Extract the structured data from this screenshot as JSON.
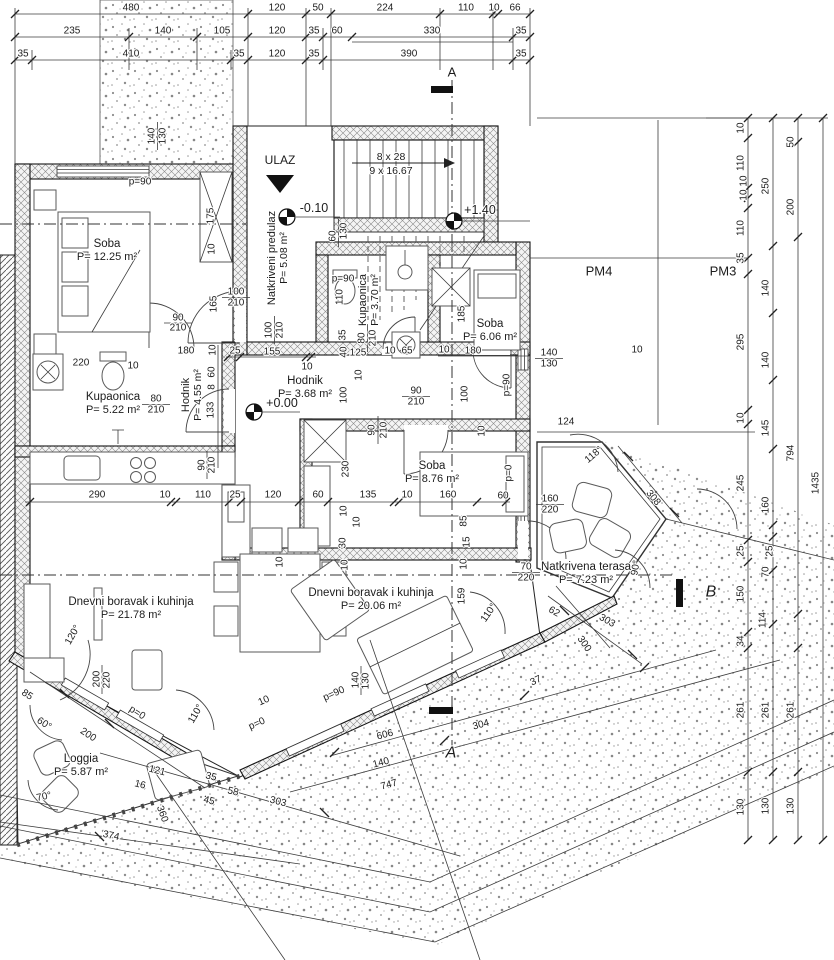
{
  "drawing": {
    "kind": "floor-plan",
    "entry_label": "ULAZ",
    "stairs": {
      "line1": "8 x 28",
      "line2": "9 x 16.67"
    },
    "levels": [
      {
        "t": "-0.10",
        "x": 314,
        "y": 208
      },
      {
        "t": "+1.40",
        "x": 480,
        "y": 210
      },
      {
        "t": "+0.00",
        "x": 282,
        "y": 403
      }
    ],
    "parking": [
      {
        "t": "PM4",
        "x": 599,
        "y": 271
      },
      {
        "t": "PM3",
        "x": 723,
        "y": 271
      }
    ],
    "sections": [
      {
        "t": "A",
        "x": 452,
        "y": 72
      },
      {
        "t": "A",
        "x": 451,
        "y": 753
      },
      {
        "t": "B",
        "x": 711,
        "y": 592
      }
    ],
    "rooms": [
      {
        "name": "Soba",
        "area": "P= 12.25 m²",
        "x": 107,
        "y": 244,
        "o": "h"
      },
      {
        "name": "Natkriveni predulaz",
        "area": "P= 5.08 m²",
        "x": 272,
        "y": 258,
        "o": "v"
      },
      {
        "name": "Kupaonica",
        "area": "P= 3.70 m²",
        "x": 363,
        "y": 300,
        "o": "v"
      },
      {
        "name": "Soba",
        "area": "P= 6.06 m²",
        "x": 490,
        "y": 324,
        "o": "h"
      },
      {
        "name": "Kupaonica",
        "area": "P= 5.22 m²",
        "x": 113,
        "y": 397,
        "o": "h"
      },
      {
        "name": "Hodnik",
        "area": "P= 4.55 m²",
        "x": 186,
        "y": 395,
        "o": "v"
      },
      {
        "name": "Hodnik",
        "area": "P= 3.68 m²",
        "x": 305,
        "y": 381,
        "o": "h"
      },
      {
        "name": "Soba",
        "area": "P= 8.76 m²",
        "x": 432,
        "y": 466,
        "o": "h"
      },
      {
        "name": "Dnevni boravak i kuhinja",
        "area": "P= 21.78 m²",
        "x": 131,
        "y": 602,
        "o": "h"
      },
      {
        "name": "Dnevni boravak i kuhinja",
        "area": "P= 20.06 m²",
        "x": 371,
        "y": 593,
        "o": "h"
      },
      {
        "name": "Loggia",
        "area": "P= 5.87 m²",
        "x": 81,
        "y": 759,
        "o": "h"
      },
      {
        "name": "Natkrivena terasa",
        "area": "P= 7.23 m²",
        "x": 586,
        "y": 567,
        "o": "h"
      }
    ],
    "dims": [
      {
        "t": "480",
        "x": 131,
        "y": 8
      },
      {
        "t": "120",
        "x": 277,
        "y": 8
      },
      {
        "t": "50",
        "x": 318,
        "y": 8
      },
      {
        "t": "224",
        "x": 385,
        "y": 8
      },
      {
        "t": "110",
        "x": 466,
        "y": 8
      },
      {
        "t": "10",
        "x": 494,
        "y": 8
      },
      {
        "t": "66",
        "x": 515,
        "y": 8
      },
      {
        "t": "235",
        "x": 72,
        "y": 31
      },
      {
        "t": "140",
        "x": 163,
        "y": 31
      },
      {
        "t": "105",
        "x": 222,
        "y": 31
      },
      {
        "t": "120",
        "x": 277,
        "y": 31
      },
      {
        "t": "35",
        "x": 314,
        "y": 31
      },
      {
        "t": "60",
        "x": 337,
        "y": 31
      },
      {
        "t": "330",
        "x": 432,
        "y": 31
      },
      {
        "t": "35",
        "x": 521,
        "y": 31
      },
      {
        "t": "35",
        "x": 23,
        "y": 54
      },
      {
        "t": "410",
        "x": 131,
        "y": 54
      },
      {
        "t": "35",
        "x": 239,
        "y": 54
      },
      {
        "t": "120",
        "x": 277,
        "y": 54
      },
      {
        "t": "35",
        "x": 314,
        "y": 54
      },
      {
        "t": "390",
        "x": 409,
        "y": 54
      },
      {
        "t": "35",
        "x": 521,
        "y": 54
      },
      {
        "t": "p=90",
        "x": 140,
        "y": 182
      },
      {
        "t": "140",
        "x": 152,
        "y": 136,
        "r": -90
      },
      {
        "t": "130",
        "x": 163,
        "y": 136,
        "r": -90
      },
      {
        "t": "175",
        "x": 211,
        "y": 216,
        "r": -90
      },
      {
        "t": "10",
        "x": 212,
        "y": 249,
        "r": -90
      },
      {
        "t": "60",
        "x": 333,
        "y": 236,
        "r": -90
      },
      {
        "t": "130",
        "x": 344,
        "y": 231,
        "r": -90
      },
      {
        "t": "100",
        "x": 269,
        "y": 330,
        "r": -90
      },
      {
        "t": "210",
        "x": 280,
        "y": 330,
        "r": -90
      },
      {
        "t": "100",
        "x": 236,
        "y": 292
      },
      {
        "t": "210",
        "x": 236,
        "y": 303
      },
      {
        "t": "90",
        "x": 178,
        "y": 318
      },
      {
        "t": "210",
        "x": 178,
        "y": 328
      },
      {
        "t": "165",
        "x": 214,
        "y": 304,
        "r": -90
      },
      {
        "t": "180",
        "x": 186,
        "y": 351
      },
      {
        "t": "25",
        "x": 235,
        "y": 351
      },
      {
        "t": "155",
        "x": 272,
        "y": 352
      },
      {
        "t": "10",
        "x": 307,
        "y": 367
      },
      {
        "t": "220",
        "x": 81,
        "y": 363
      },
      {
        "t": "10",
        "x": 133,
        "y": 366
      },
      {
        "t": "10",
        "x": 213,
        "y": 350,
        "r": -90
      },
      {
        "t": "60",
        "x": 212,
        "y": 372,
        "r": -90
      },
      {
        "t": "8",
        "x": 212,
        "y": 387,
        "r": -90
      },
      {
        "t": "133",
        "x": 211,
        "y": 410,
        "r": -90
      },
      {
        "t": "80",
        "x": 156,
        "y": 399
      },
      {
        "t": "210",
        "x": 156,
        "y": 410
      },
      {
        "t": "90",
        "x": 202,
        "y": 465,
        "r": -90
      },
      {
        "t": "210",
        "x": 212,
        "y": 465,
        "r": -90
      },
      {
        "t": "p=90",
        "x": 343,
        "y": 279
      },
      {
        "t": "110",
        "x": 340,
        "y": 297,
        "r": -90
      },
      {
        "t": "35",
        "x": 343,
        "y": 335,
        "r": -90
      },
      {
        "t": "40",
        "x": 344,
        "y": 352,
        "r": -90
      },
      {
        "t": "125",
        "x": 358,
        "y": 353
      },
      {
        "t": "10",
        "x": 390,
        "y": 351
      },
      {
        "t": "65",
        "x": 407,
        "y": 351
      },
      {
        "t": "10",
        "x": 444,
        "y": 350
      },
      {
        "t": "180",
        "x": 473,
        "y": 351
      },
      {
        "t": "10",
        "x": 637,
        "y": 350
      },
      {
        "t": "80",
        "x": 362,
        "y": 338,
        "r": -90
      },
      {
        "t": "210",
        "x": 373,
        "y": 338,
        "r": -90
      },
      {
        "t": "10",
        "x": 359,
        "y": 375,
        "r": -90
      },
      {
        "t": "100",
        "x": 344,
        "y": 395,
        "r": -90
      },
      {
        "t": "90",
        "x": 416,
        "y": 391
      },
      {
        "t": "210",
        "x": 416,
        "y": 402
      },
      {
        "t": "100",
        "x": 465,
        "y": 394,
        "r": -90
      },
      {
        "t": "90",
        "x": 372,
        "y": 430,
        "r": -90
      },
      {
        "t": "210",
        "x": 384,
        "y": 430,
        "r": -90
      },
      {
        "t": "230",
        "x": 346,
        "y": 469,
        "r": -90
      },
      {
        "t": "185",
        "x": 462,
        "y": 314,
        "r": -90
      },
      {
        "t": "140",
        "x": 549,
        "y": 353
      },
      {
        "t": "130",
        "x": 549,
        "y": 364
      },
      {
        "t": "p=90",
        "x": 507,
        "y": 385,
        "r": -90
      },
      {
        "t": "10",
        "x": 482,
        "y": 431,
        "r": -90
      },
      {
        "t": "124",
        "x": 566,
        "y": 422
      },
      {
        "t": "290",
        "x": 97,
        "y": 495
      },
      {
        "t": "10",
        "x": 165,
        "y": 495
      },
      {
        "t": "110",
        "x": 203,
        "y": 495
      },
      {
        "t": "25",
        "x": 235,
        "y": 495
      },
      {
        "t": "120",
        "x": 273,
        "y": 495
      },
      {
        "t": "60",
        "x": 318,
        "y": 495
      },
      {
        "t": "135",
        "x": 368,
        "y": 495
      },
      {
        "t": "10",
        "x": 407,
        "y": 495
      },
      {
        "t": "160",
        "x": 448,
        "y": 495
      },
      {
        "t": "60",
        "x": 503,
        "y": 496
      },
      {
        "t": "160",
        "x": 550,
        "y": 499
      },
      {
        "t": "220",
        "x": 550,
        "y": 510
      },
      {
        "t": "10",
        "x": 344,
        "y": 511,
        "r": -90
      },
      {
        "t": "10",
        "x": 357,
        "y": 522,
        "r": -90
      },
      {
        "t": "30",
        "x": 343,
        "y": 543,
        "r": -90
      },
      {
        "t": "10",
        "x": 345,
        "y": 565,
        "r": -90
      },
      {
        "t": "85",
        "x": 464,
        "y": 521,
        "r": -90
      },
      {
        "t": "15",
        "x": 467,
        "y": 542,
        "r": -90
      },
      {
        "t": "10",
        "x": 464,
        "y": 564,
        "r": -90
      },
      {
        "t": "70",
        "x": 526,
        "y": 567
      },
      {
        "t": "220",
        "x": 526,
        "y": 578
      },
      {
        "t": "10",
        "x": 280,
        "y": 562,
        "r": -90
      },
      {
        "t": "159",
        "x": 462,
        "y": 596,
        "r": -90
      },
      {
        "t": "140",
        "x": 356,
        "y": 680,
        "r": -90
      },
      {
        "t": "130",
        "x": 366,
        "y": 681,
        "r": -90
      },
      {
        "t": "200",
        "x": 97,
        "y": 679,
        "r": -90
      },
      {
        "t": "220",
        "x": 107,
        "y": 680,
        "r": -90
      },
      {
        "t": "120°",
        "x": 73,
        "y": 635,
        "r": -60
      },
      {
        "t": "110°",
        "x": 196,
        "y": 714,
        "r": -60
      },
      {
        "t": "110°",
        "x": 489,
        "y": 613,
        "r": -55
      },
      {
        "t": "60°",
        "x": 44,
        "y": 724,
        "r": 33
      },
      {
        "t": "70°",
        "x": 44,
        "y": 797,
        "r": -12
      },
      {
        "t": "85",
        "x": 27,
        "y": 695,
        "r": 33
      },
      {
        "t": "200",
        "x": 88,
        "y": 735,
        "r": 33
      },
      {
        "t": "p=0",
        "x": 137,
        "y": 713,
        "r": 33
      },
      {
        "t": "p=0",
        "x": 509,
        "y": 473,
        "r": -90
      },
      {
        "t": "p=0",
        "x": 257,
        "y": 724,
        "r": -24
      },
      {
        "t": "10",
        "x": 264,
        "y": 701,
        "r": -24
      },
      {
        "t": "p=90",
        "x": 334,
        "y": 694,
        "r": -24
      },
      {
        "t": "121",
        "x": 157,
        "y": 771,
        "r": 14
      },
      {
        "t": "16",
        "x": 140,
        "y": 785,
        "r": 14
      },
      {
        "t": "35",
        "x": 211,
        "y": 777,
        "r": 14
      },
      {
        "t": "45",
        "x": 209,
        "y": 801,
        "r": 14
      },
      {
        "t": "58",
        "x": 233,
        "y": 792,
        "r": 14
      },
      {
        "t": "303",
        "x": 278,
        "y": 802,
        "r": 14
      },
      {
        "t": "374",
        "x": 111,
        "y": 836,
        "r": 12
      },
      {
        "t": "360",
        "x": 162,
        "y": 814,
        "r": 70
      },
      {
        "t": "606",
        "x": 385,
        "y": 735,
        "r": -15
      },
      {
        "t": "304",
        "x": 481,
        "y": 725,
        "r": -15
      },
      {
        "t": "140",
        "x": 381,
        "y": 763,
        "r": -15
      },
      {
        "t": "747",
        "x": 389,
        "y": 785,
        "r": -15
      },
      {
        "t": "37",
        "x": 536,
        "y": 681,
        "r": -25
      },
      {
        "t": "118°",
        "x": 594,
        "y": 455,
        "r": -40
      },
      {
        "t": "308",
        "x": 653,
        "y": 498,
        "r": 50
      },
      {
        "t": "90°",
        "x": 636,
        "y": 568,
        "r": -80
      },
      {
        "t": "62",
        "x": 554,
        "y": 612,
        "r": 30
      },
      {
        "t": "303",
        "x": 607,
        "y": 621,
        "r": 30
      },
      {
        "t": "300",
        "x": 584,
        "y": 644,
        "r": 55
      },
      {
        "t": "10",
        "x": 741,
        "y": 128,
        "r": -90
      },
      {
        "t": "110",
        "x": 741,
        "y": 163,
        "r": -90
      },
      {
        "t": "10",
        "x": 744,
        "y": 181,
        "r": -90
      },
      {
        "t": "10",
        "x": 744,
        "y": 195,
        "r": -90
      },
      {
        "t": "110",
        "x": 741,
        "y": 228,
        "r": -90
      },
      {
        "t": "35",
        "x": 741,
        "y": 258,
        "r": -90
      },
      {
        "t": "295",
        "x": 741,
        "y": 342,
        "r": -90
      },
      {
        "t": "10",
        "x": 741,
        "y": 418,
        "r": -90
      },
      {
        "t": "245",
        "x": 741,
        "y": 483,
        "r": -90
      },
      {
        "t": "25",
        "x": 741,
        "y": 551,
        "r": -90
      },
      {
        "t": "150",
        "x": 741,
        "y": 594,
        "r": -90
      },
      {
        "t": "34",
        "x": 741,
        "y": 641,
        "r": -90
      },
      {
        "t": "261",
        "x": 741,
        "y": 710,
        "r": -90
      },
      {
        "t": "130",
        "x": 741,
        "y": 807,
        "r": -90
      },
      {
        "t": "250",
        "x": 766,
        "y": 186,
        "r": -90
      },
      {
        "t": "140",
        "x": 766,
        "y": 288,
        "r": -90
      },
      {
        "t": "140",
        "x": 766,
        "y": 360,
        "r": -90
      },
      {
        "t": "145",
        "x": 766,
        "y": 428,
        "r": -90
      },
      {
        "t": "160",
        "x": 766,
        "y": 505,
        "r": -90
      },
      {
        "t": "25",
        "x": 770,
        "y": 551,
        "r": -90
      },
      {
        "t": "70",
        "x": 766,
        "y": 572,
        "r": -90
      },
      {
        "t": "114",
        "x": 763,
        "y": 620,
        "r": -90
      },
      {
        "t": "261",
        "x": 766,
        "y": 710,
        "r": -90
      },
      {
        "t": "130",
        "x": 766,
        "y": 806,
        "r": -90
      },
      {
        "t": "50",
        "x": 791,
        "y": 142,
        "r": -90
      },
      {
        "t": "200",
        "x": 791,
        "y": 207,
        "r": -90
      },
      {
        "t": "794",
        "x": 791,
        "y": 453,
        "r": -90
      },
      {
        "t": "261",
        "x": 791,
        "y": 710,
        "r": -90
      },
      {
        "t": "130",
        "x": 791,
        "y": 806,
        "r": -90
      },
      {
        "t": "1435",
        "x": 816,
        "y": 483,
        "r": -90
      }
    ]
  }
}
